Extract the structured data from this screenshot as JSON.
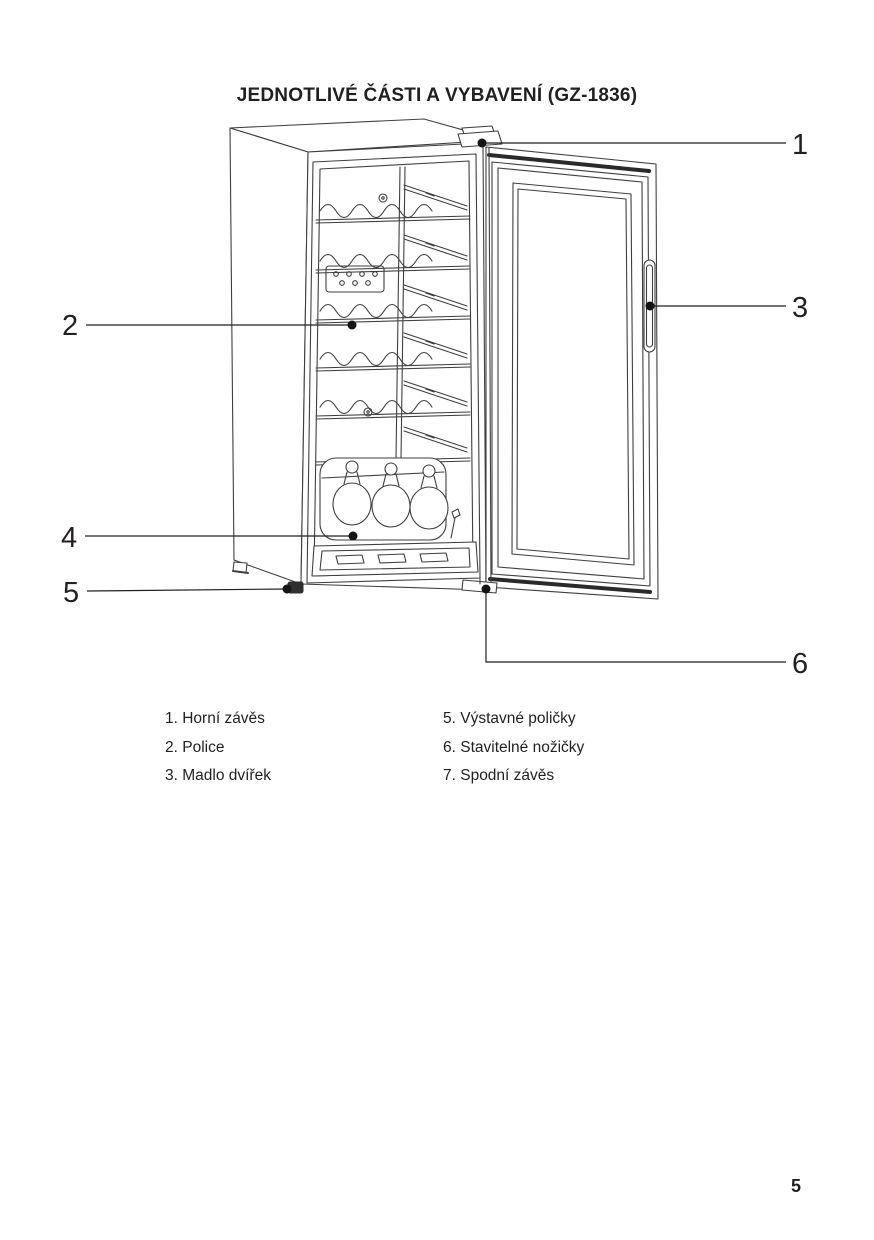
{
  "page": {
    "title": "JEDNOTLIVÉ ČÁSTI A VYBAVENÍ (GZ-1836)",
    "page_number": "5"
  },
  "diagram": {
    "callout_numbers": [
      "1",
      "2",
      "3",
      "4",
      "5",
      "6"
    ]
  },
  "parts_list": {
    "left_column": [
      "1. Horní závěs",
      "2. Police",
      "3. Madlo dvířek"
    ],
    "right_column": [
      "5. Výstavné poličky",
      "6. Stavitelné nožičky",
      "7. Spodní závěs"
    ]
  },
  "colors": {
    "text": "#231f20",
    "line_art": "#3f3f3f",
    "background": "#ffffff"
  }
}
